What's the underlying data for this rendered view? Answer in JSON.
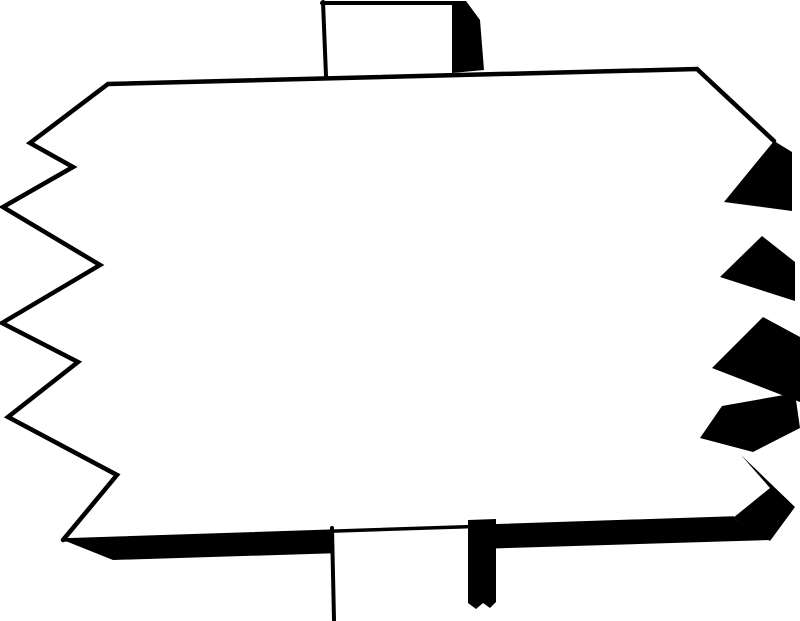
{
  "meta": {
    "subject": "blank-jagged-signboard-on-post",
    "width": 800,
    "height": 621
  },
  "colors": {
    "ink": "#000000",
    "paper": "#ffffff"
  },
  "drawing": {
    "viewbox": "0 0 800 621",
    "shapes": [
      {
        "name": "sign-board-face",
        "type": "polygon",
        "fill": "paper",
        "points": [
          [
            108,
            84
          ],
          [
            697,
            69
          ],
          [
            774,
            141
          ],
          [
            724,
            202
          ],
          [
            762,
            236
          ],
          [
            720,
            277
          ],
          [
            763,
            317
          ],
          [
            712,
            368
          ],
          [
            722,
            406
          ],
          [
            700,
            438
          ],
          [
            770,
            487
          ],
          [
            733,
            517
          ],
          [
            63,
            540
          ],
          [
            117,
            475
          ],
          [
            8,
            417
          ],
          [
            78,
            362
          ],
          [
            2,
            323
          ],
          [
            100,
            265
          ],
          [
            3,
            207
          ],
          [
            73,
            167
          ],
          [
            30,
            143
          ]
        ]
      },
      {
        "name": "right-shadow-band-1",
        "type": "polygon",
        "fill": "ink",
        "points": [
          [
            774,
            141
          ],
          [
            792,
            152
          ],
          [
            792,
            211
          ],
          [
            724,
            202
          ]
        ]
      },
      {
        "name": "right-shadow-band-2",
        "type": "polygon",
        "fill": "ink",
        "points": [
          [
            762,
            236
          ],
          [
            795,
            262
          ],
          [
            795,
            301
          ],
          [
            720,
            277
          ]
        ]
      },
      {
        "name": "right-shadow-band-3",
        "type": "polygon",
        "fill": "ink",
        "points": [
          [
            763,
            317
          ],
          [
            800,
            337
          ],
          [
            800,
            402
          ],
          [
            712,
            368
          ]
        ]
      },
      {
        "name": "right-shadow-band-4",
        "type": "polygon",
        "fill": "ink",
        "points": [
          [
            722,
            406
          ],
          [
            795,
            393
          ],
          [
            800,
            428
          ],
          [
            753,
            452
          ],
          [
            700,
            438
          ]
        ]
      },
      {
        "name": "corner-shadow-piece",
        "type": "polygon",
        "fill": "ink",
        "points": [
          [
            741,
            455
          ],
          [
            795,
            507
          ],
          [
            770,
            541
          ],
          [
            733,
            518
          ],
          [
            770,
            488
          ]
        ]
      },
      {
        "name": "bottom-shadow-band",
        "type": "polygon",
        "fill": "ink",
        "points": [
          [
            63,
            540
          ],
          [
            733,
            518
          ],
          [
            770,
            540
          ],
          [
            113,
            560
          ]
        ]
      },
      {
        "name": "bottom-post-face",
        "type": "polygon",
        "fill": "paper",
        "points": [
          [
            332,
            522
          ],
          [
            468,
            519
          ],
          [
            468,
            621
          ],
          [
            332,
            621
          ]
        ]
      },
      {
        "name": "bottom-post-shadow",
        "type": "polygon",
        "fill": "ink",
        "points": [
          [
            468,
            520
          ],
          [
            496,
            519
          ],
          [
            496,
            602
          ],
          [
            490,
            608
          ],
          [
            483,
            603
          ],
          [
            476,
            609
          ],
          [
            468,
            603
          ]
        ]
      },
      {
        "name": "top-post-face",
        "type": "polygon",
        "fill": "paper",
        "points": [
          [
            322,
            1
          ],
          [
            452,
            1
          ],
          [
            452,
            75
          ],
          [
            326,
            77
          ]
        ]
      },
      {
        "name": "top-post-shadow",
        "type": "polygon",
        "fill": "ink",
        "points": [
          [
            452,
            1
          ],
          [
            466,
            1
          ],
          [
            480,
            20
          ],
          [
            484,
            70
          ],
          [
            452,
            73
          ]
        ]
      },
      {
        "name": "board-outline-top-left",
        "type": "polyline",
        "stroke": "ink",
        "stroke_width": 4.5,
        "points": [
          [
            774,
            141
          ],
          [
            697,
            69
          ],
          [
            108,
            84
          ],
          [
            30,
            143
          ],
          [
            73,
            167
          ],
          [
            3,
            207
          ],
          [
            100,
            265
          ],
          [
            2,
            323
          ],
          [
            78,
            362
          ],
          [
            8,
            417
          ],
          [
            117,
            475
          ],
          [
            63,
            540
          ]
        ]
      },
      {
        "name": "board-bottom-edge-line",
        "type": "polyline",
        "stroke": "ink",
        "stroke_width": 3.5,
        "points": [
          [
            63,
            540
          ],
          [
            733,
            518
          ]
        ]
      },
      {
        "name": "top-post-top-line",
        "type": "polyline",
        "stroke": "ink",
        "stroke_width": 4,
        "points": [
          [
            322,
            3
          ],
          [
            453,
            3
          ]
        ]
      },
      {
        "name": "top-post-left-line",
        "type": "polyline",
        "stroke": "ink",
        "stroke_width": 4,
        "points": [
          [
            323,
            2
          ],
          [
            326,
            76
          ]
        ]
      },
      {
        "name": "bottom-post-left-line",
        "type": "polyline",
        "stroke": "ink",
        "stroke_width": 4,
        "points": [
          [
            332,
            528
          ],
          [
            334,
            620
          ]
        ]
      }
    ]
  }
}
